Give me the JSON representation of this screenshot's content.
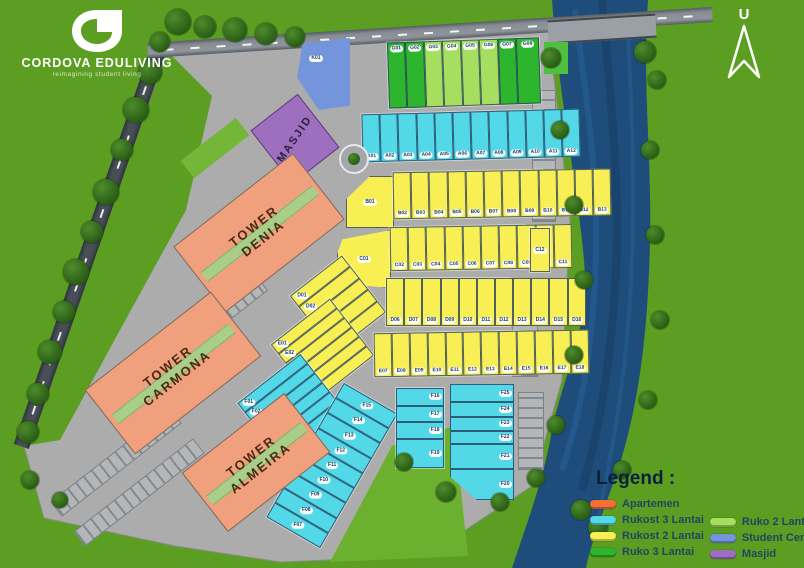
{
  "brand": {
    "name": "CORDOVA EDULIVING",
    "tagline": "reimagining student living"
  },
  "compass": {
    "label": "U"
  },
  "legend": {
    "title": "Legend :",
    "columns": [
      [
        {
          "label": "Apartemen",
          "color": "#F46F38"
        },
        {
          "label": "Rukost 3 Lantai",
          "color": "#53D8E8"
        },
        {
          "label": "Rukost 2 Lantai",
          "color": "#F8EF54"
        },
        {
          "label": "Ruko 3 Lantai",
          "color": "#2DB52D"
        }
      ],
      [
        {
          "label": "Ruko 2 Lantai",
          "color": "#A6DF60"
        },
        {
          "label": "Student Center",
          "color": "#7495DB"
        },
        {
          "label": "Masjid",
          "color": "#9E6FBE"
        }
      ]
    ]
  },
  "buildings": {
    "masjid": "MASJID",
    "student_center": "K01",
    "towers": [
      "TOWER\nDENIA",
      "TOWER\nCARMONA",
      "TOWER\nALMEIRA"
    ]
  },
  "units": {
    "ruko_top": [
      {
        "id": "G01",
        "t": "g3"
      },
      {
        "id": "G02",
        "t": "g3"
      },
      {
        "id": "G03",
        "t": "g2"
      },
      {
        "id": "G04",
        "t": "g2"
      },
      {
        "id": "G05",
        "t": "g2"
      },
      {
        "id": "G06",
        "t": "g2"
      },
      {
        "id": "G07",
        "t": "g3",
        "f": "0.8"
      },
      {
        "id": "G08",
        "t": "g3",
        "f": "1.5"
      }
    ],
    "rukost_a": [
      "A01",
      "A02",
      "A03",
      "A04",
      "A05",
      "A06",
      "A07",
      "A08",
      "A09",
      "A10",
      "A11",
      "A12"
    ],
    "b_head": "B01",
    "b_row": [
      "B02",
      "B03",
      "B04",
      "B05",
      "B06",
      "B07",
      "B08",
      "B09",
      "B10",
      "B11",
      "B12",
      "B13"
    ],
    "c_head": "C01",
    "c_row": [
      "C02",
      "C03",
      "C04",
      "C05",
      "C06",
      "C07",
      "C08",
      "C09",
      "C10",
      "C11"
    ],
    "c_end": "C12",
    "d_fan": [
      "D01",
      "D02",
      "D03",
      "D04",
      "D05"
    ],
    "d_row": [
      "D06",
      "D07",
      "D08",
      "D09",
      "D10",
      "D11",
      "D12",
      "D13",
      "D14",
      "D15",
      "D16"
    ],
    "e_fan": [
      "E01",
      "E02",
      "E03",
      "E04",
      "E05",
      "E06"
    ],
    "e_row": [
      "E07",
      "E08",
      "E09",
      "E10",
      "E11",
      "E12",
      "E13",
      "E14",
      "E15",
      "E16",
      "E17",
      "E18"
    ],
    "f_fan": [
      "F01",
      "F02",
      "F03",
      "F04",
      "F05",
      "F06"
    ],
    "f_stack": [
      "F15",
      "F14",
      "F13",
      "F12",
      "F11",
      "F10",
      "F09",
      "F08",
      "F07"
    ],
    "f_col1": [
      "F16",
      "F17",
      "F18",
      "F19"
    ],
    "f_col2": [
      "F25",
      "F24",
      "F23",
      "F22",
      "F21",
      "F20"
    ]
  },
  "colors": {
    "grass": "#5C9E22",
    "pavement": "#ACACAC",
    "river": "#1E4C7B",
    "apartemen": "#F0A07C",
    "rukost3": "#53D8E8",
    "rukost2": "#F8EF54",
    "ruko3": "#2DB52D",
    "ruko2": "#A6DF60",
    "student_center": "#7495DB",
    "masjid": "#9E6FBE"
  }
}
